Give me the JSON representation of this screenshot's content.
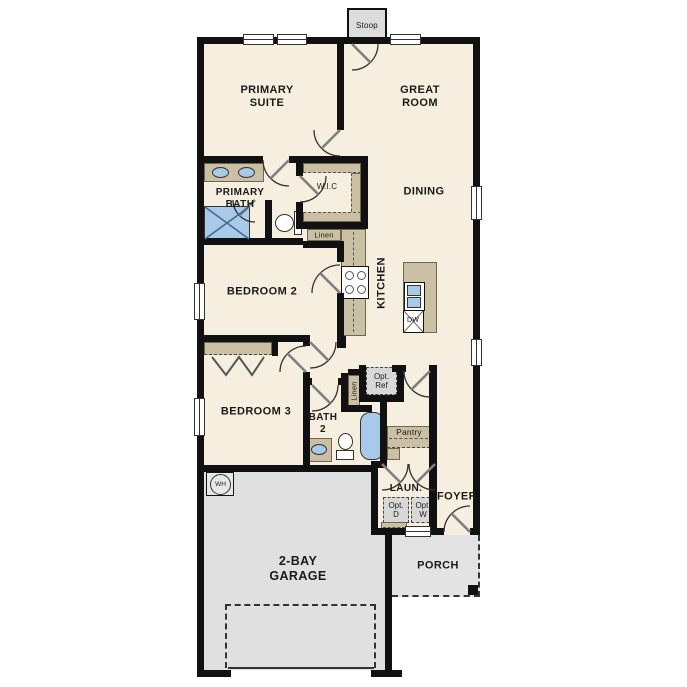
{
  "plan": {
    "type": "single-story-floor-plan",
    "labels": {
      "stoop": "Stoop",
      "primary_suite": "PRIMARY\nSUITE",
      "great_room": "GREAT\nROOM",
      "primary_bath": "PRIMARY\nBATH",
      "wic": "W.I.C",
      "dining": "DINING",
      "kitchen": "KITCHEN",
      "linen_kitchen": "Linen",
      "bedroom_2": "BEDROOM 2",
      "bedroom_3": "BEDROOM 3",
      "bath_2": "BATH\n2",
      "linen_bath": "Linen",
      "opt_ref": "Opt.\nRef",
      "pantry": "Pantry",
      "laundry": "LAUN.",
      "foyer": "FOYER",
      "opt_dryer": "Opt.\nD",
      "opt_washer": "Opt.\nW",
      "water_heater": "WH",
      "dishwasher": "DW",
      "garage": "2-BAY\nGARAGE",
      "porch": "PORCH"
    },
    "colors": {
      "wall": "#111111",
      "floor": "#f6efe0",
      "counter_tan": "#cbbfa4",
      "fixture_blue": "#a9c9e9",
      "garage_gray": "#e0e0e0",
      "porch_gray": "#e3e3e3",
      "stoop_gray": "#dcdcdc",
      "optional_gray": "#d8d8d8"
    }
  }
}
